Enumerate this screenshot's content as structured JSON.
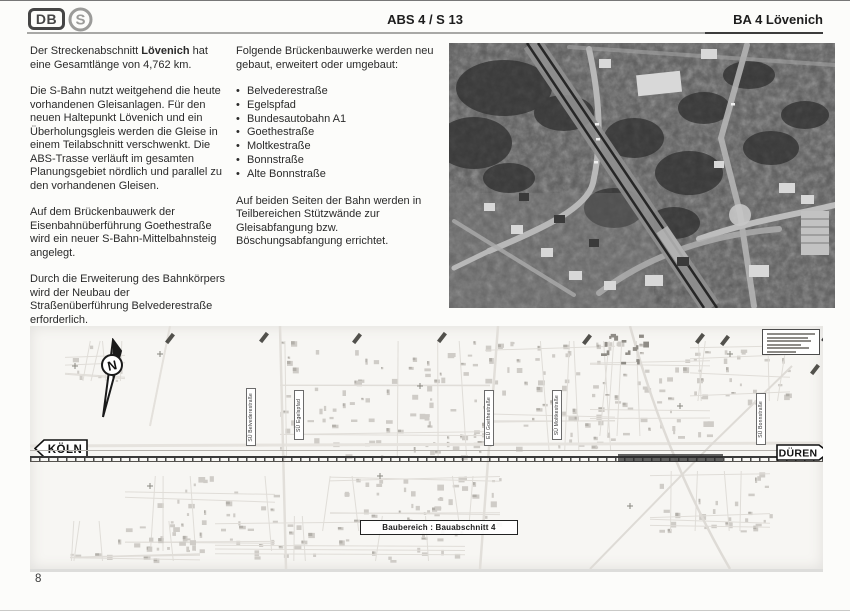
{
  "header": {
    "db_logo": "DB",
    "s_logo": "S",
    "center_title": "ABS 4 / S 13",
    "right_title": "BA 4 Lövenich"
  },
  "left_column": {
    "para1_pre": "Der Streckenabschnitt ",
    "para1_bold": "Lövenich",
    "para1_post": " hat eine Gesamtlänge von 4,762 km.",
    "para2": "Die S-Bahn nutzt weitgehend die heute vorhandenen Gleisanlagen. Für den neuen Haltepunkt Lövenich und ein Überholungsgleis werden die Gleise in einem Teilabschnitt verschwenkt. Die ABS-Trasse verläuft im gesamten Planungsgebiet nördlich und parallel zu den vorhandenen Gleisen.",
    "para3": "Auf dem Brückenbauwerk der Eisenbahn­überführung Goethestraße wird ein neuer S-Bahn-Mittelbahnsteig angelegt.",
    "para4": "Durch die Erweiterung des Bahnkörpers wird der Neubau der Straßenüberführung Belvederestraße erforderlich."
  },
  "middle_column": {
    "intro": "Folgende Brückenbauwerke werden neu gebaut, erweitert oder umgebaut:",
    "bullets": [
      "Belvederestraße",
      "Egelspfad",
      "Bundesautobahn A1",
      "Goethestraße",
      "Moltkestraße",
      "Bonnstraße",
      "Alte Bonnstraße"
    ],
    "outro": "Auf beiden Seiten der Bahn werden in Teilbereichen Stützwände zur Gleisabfangung bzw. Böschungsabfangung errichtet."
  },
  "map": {
    "north_label": "N",
    "koeln_sign": "KÖLN",
    "dueren_sign": "DÜREN",
    "area_label": "Baubereich : Bauabschnitt 4",
    "bridge_labels": [
      "SÜ Belvederestraße",
      "SÜ Egelspfad",
      "EÜ Goethestraße",
      "SÜ Moltkestraße",
      "SÜ Bonnstraße"
    ]
  },
  "page_number": "8"
}
